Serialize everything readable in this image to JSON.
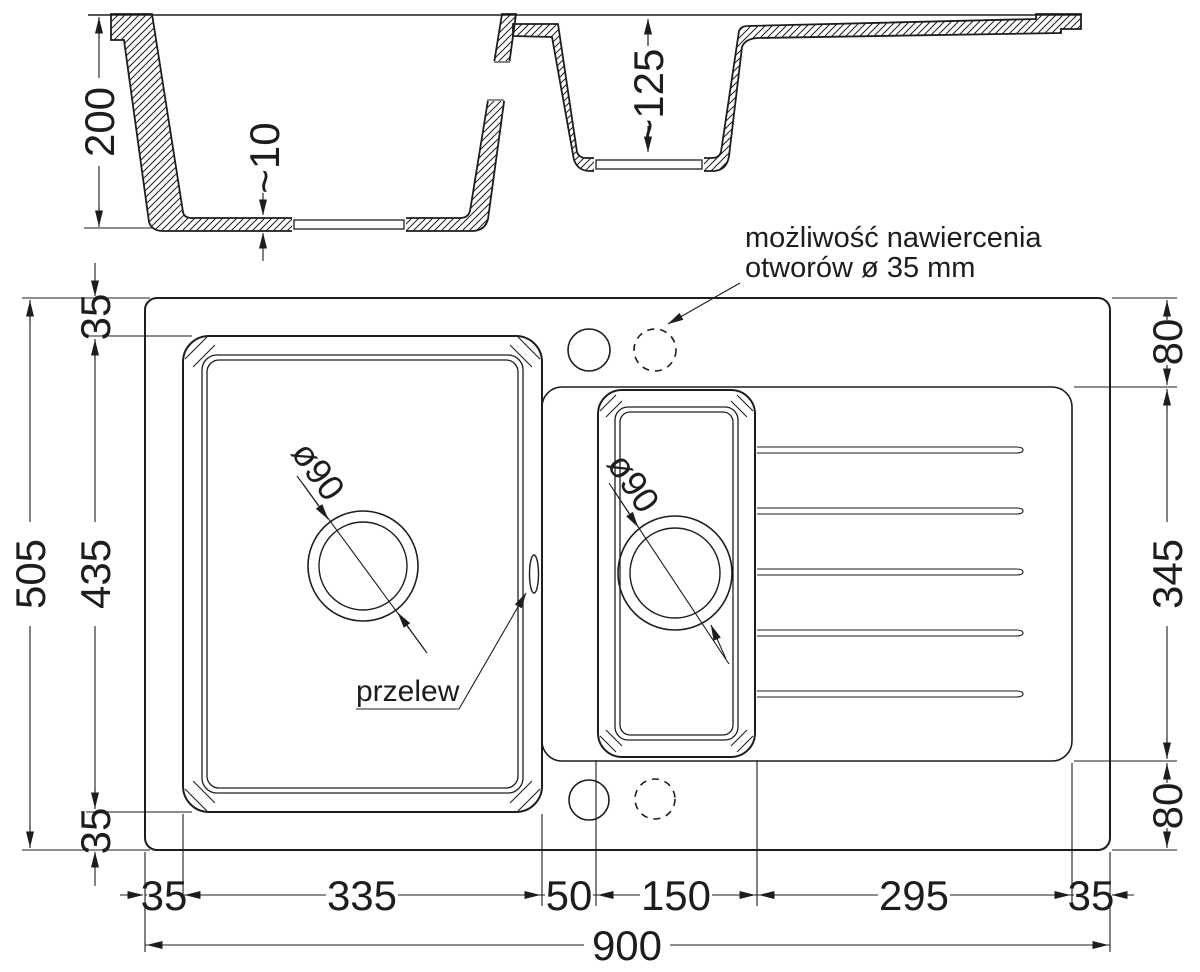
{
  "section": {
    "depth_main_bowl": "200",
    "floor_thickness": "~10",
    "depth_small_bowl": "~125"
  },
  "plan": {
    "overall_width": "900",
    "overall_depth": "505",
    "bowl_zone_depth": "435",
    "margin_top": "35",
    "margin_bottom": "35",
    "margin_left": "35",
    "margin_right": "35",
    "main_bowl_width": "335",
    "divider_width": "50",
    "small_bowl_width": "150",
    "drainer_width": "295",
    "deck_top": "80",
    "drainer_depth": "345",
    "deck_bottom": "80",
    "main_drain_diameter": "ø90",
    "small_drain_diameter": "ø90"
  },
  "labels": {
    "overflow": "przelew",
    "note_line1": "możliwość nawiercenia",
    "note_line2": "otworów ø 35 mm"
  },
  "colors": {
    "line": "#1d1d1b",
    "background": "#ffffff"
  }
}
